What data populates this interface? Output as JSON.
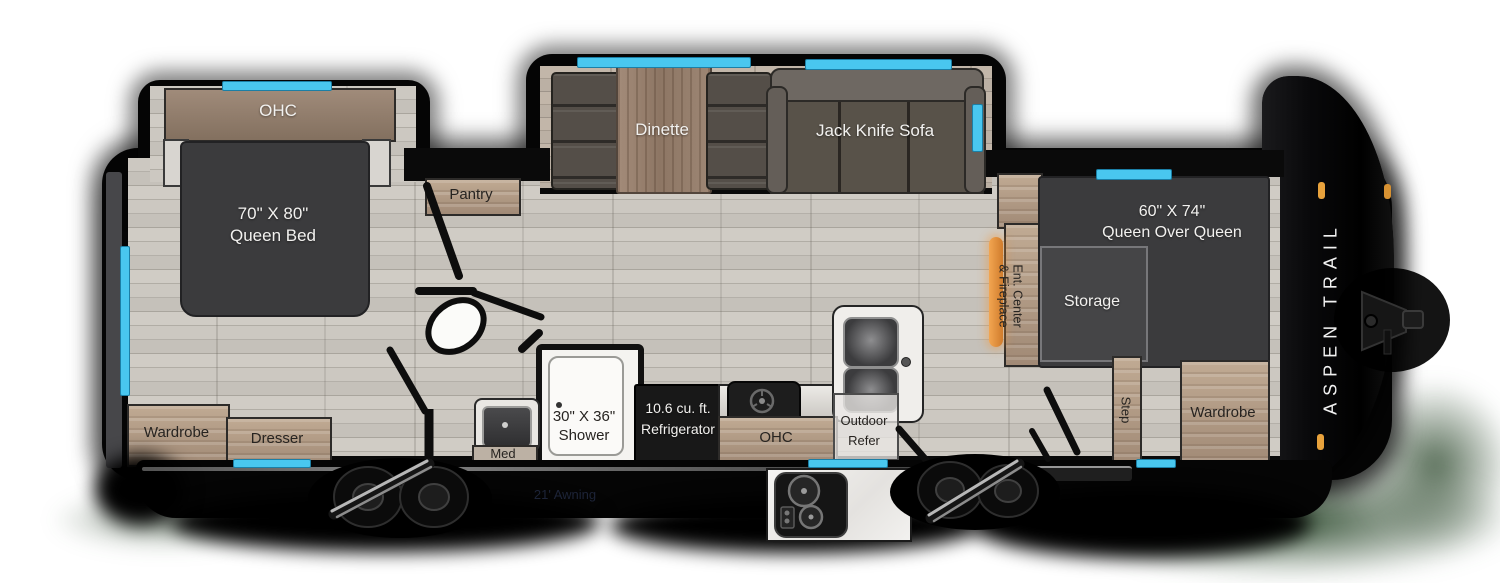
{
  "labels": {
    "bedroom_ohc": "OHC",
    "bed_size": "70\" X 80\"",
    "bed_name": "Queen Bed",
    "wardrobe_rear": "Wardrobe",
    "dresser": "Dresser",
    "pantry": "Pantry",
    "dinette": "Dinette",
    "sofa": "Jack Knife Sofa",
    "med": "Med",
    "shower_size": "30\" X 36\"",
    "shower_name": "Shower",
    "fridge_size": "10.6 cu. ft.",
    "fridge_name": "Refrigerator",
    "kitchen_ohc": "OHC",
    "outdoor_refer_l1": "Outdoor",
    "outdoor_refer_l2": "Refer",
    "ent_center_l1": "Ent. Center",
    "ent_center_l2": "& Fireplace",
    "bunk_size": "60\" X 74\"",
    "bunk_name": "Queen Over Queen",
    "storage": "Storage",
    "step": "Step",
    "wardrobe_front": "Wardrobe",
    "awning": "21' Awning",
    "brand": "ASPEN TRAIL"
  },
  "colors": {
    "window": "#49c7ef",
    "fireplace": "#e89a44",
    "marker_light": "#e8a23c",
    "furniture_dark": "#3b3b3d",
    "cabinet_tan": "#b29a89",
    "floor": "#c4c0b9"
  }
}
